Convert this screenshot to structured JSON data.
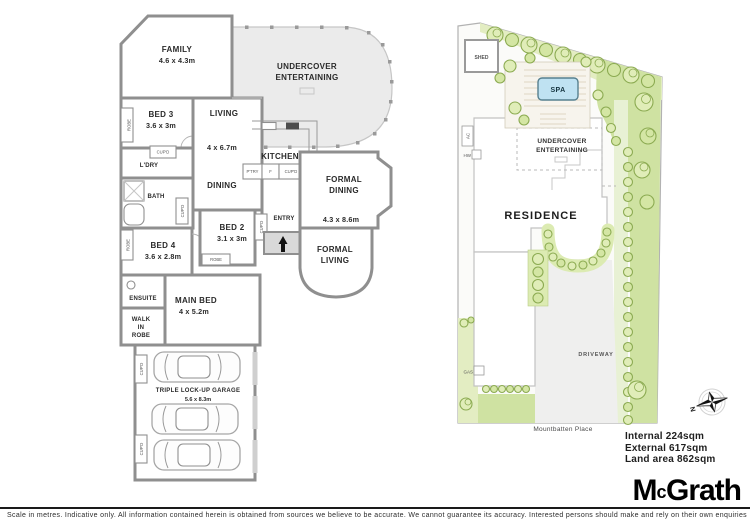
{
  "floorplan": {
    "family": {
      "name": "FAMILY",
      "dims": "4.6 x 4.3m"
    },
    "undercover": {
      "line1": "UNDERCOVER",
      "line2": "ENTERTAINING"
    },
    "bed3": {
      "name": "BED 3",
      "dims": "3.6 x 3m"
    },
    "living": {
      "name": "LIVING",
      "dims": "4 x 6.7m"
    },
    "kitchen": {
      "name": "KITCHEN",
      "dims": "3.6 x 3.5m"
    },
    "dining": {
      "name": "DINING"
    },
    "formal_dining": {
      "line1": "FORMAL",
      "line2": "DINING",
      "dims": "4.3 x 8.6m"
    },
    "formal_living": {
      "line1": "FORMAL",
      "line2": "LIVING"
    },
    "entry": {
      "name": "ENTRY"
    },
    "bed2": {
      "name": "BED 2",
      "dims": "3.1 x 3m"
    },
    "bed4": {
      "name": "BED 4",
      "dims": "3.6 x 2.8m"
    },
    "main_bed": {
      "name": "MAIN BED",
      "dims": "4 x 5.2m"
    },
    "ensuite": {
      "name": "ENSUITE"
    },
    "wir": {
      "line1": "WALK",
      "line2": "IN",
      "line3": "ROBE"
    },
    "bath": {
      "name": "BATH"
    },
    "ldry": {
      "name": "L'DRY"
    },
    "garage": {
      "name": "TRIPLE LOCK-UP GARAGE",
      "dims": "5.6 x 8.3m"
    },
    "tiny": {
      "robe": "ROBE",
      "cupd": "CUP'D",
      "ptry": "P'TRY",
      "fridge": "F"
    }
  },
  "siteplan": {
    "shed": "SHED",
    "spa": "SPA",
    "undercover_line1": "UNDERCOVER",
    "undercover_line2": "ENTERTAINING",
    "residence": "RESIDENCE",
    "driveway": "DRIVEWAY",
    "gas": "GAS",
    "ac": "AC",
    "hw": "HW",
    "street": "Mountbatten Place",
    "compass_north": "N"
  },
  "areas": {
    "internal": "Internal 224sqm",
    "external": "External 617sqm",
    "land": "Land area 862sqm"
  },
  "brand": {
    "m": "M",
    "c": "c",
    "rest": "Grath"
  },
  "footer": {
    "disclaimer": "Scale in metres. Indicative only. All information contained herein is obtained from sources we believe to be accurate. We cannot guarantee its accuracy. Interested persons should make and rely on their own enquiries"
  },
  "colors": {
    "wall_gray": "#8f8f8f",
    "terrace_fill": "#ebebeb",
    "garden_bed_green": "#e3edc2",
    "lawn_green": "#cfe2a2",
    "tree_stroke": "#8cab52",
    "spa_blue": "#bfe2f2",
    "brand_black": "#000000"
  }
}
